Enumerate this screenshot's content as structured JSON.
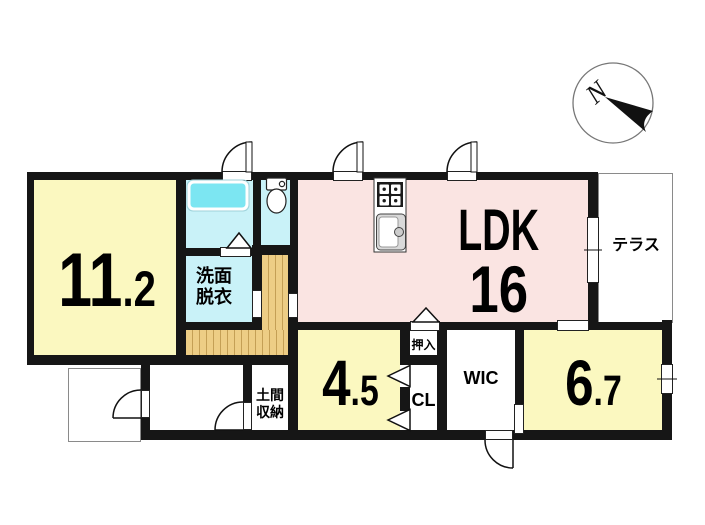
{
  "rooms": {
    "bedroom_west": {
      "size_main": "11",
      "size_frac": ".2"
    },
    "ldk": {
      "name": "LDK",
      "size": "16"
    },
    "room_45": {
      "size_main": "4",
      "size_frac": ".5"
    },
    "room_67": {
      "size_main": "6",
      "size_frac": ".7"
    },
    "terrace": {
      "label": "テラス"
    },
    "washroom": {
      "label_line1": "洗面",
      "label_line2": "脱衣"
    },
    "doma_storage": {
      "label_line1": "土間",
      "label_line2": "収納"
    },
    "oshiire": {
      "label": "押入"
    },
    "closet": {
      "label": "CL"
    },
    "wic": {
      "label": "WIC"
    }
  },
  "compass": {
    "north_label": "N"
  },
  "colors": {
    "wall": "#161616",
    "room_yellow": "#FBF8C0",
    "ldk_pink": "#FAE4E2",
    "wet_cyan": "#C9F2F8",
    "bathtub_cyan": "#7CE6F2",
    "wood_floor": "#EDCD85",
    "wood_line": "#C49F55",
    "terrace_border": "#8A8A8A"
  }
}
